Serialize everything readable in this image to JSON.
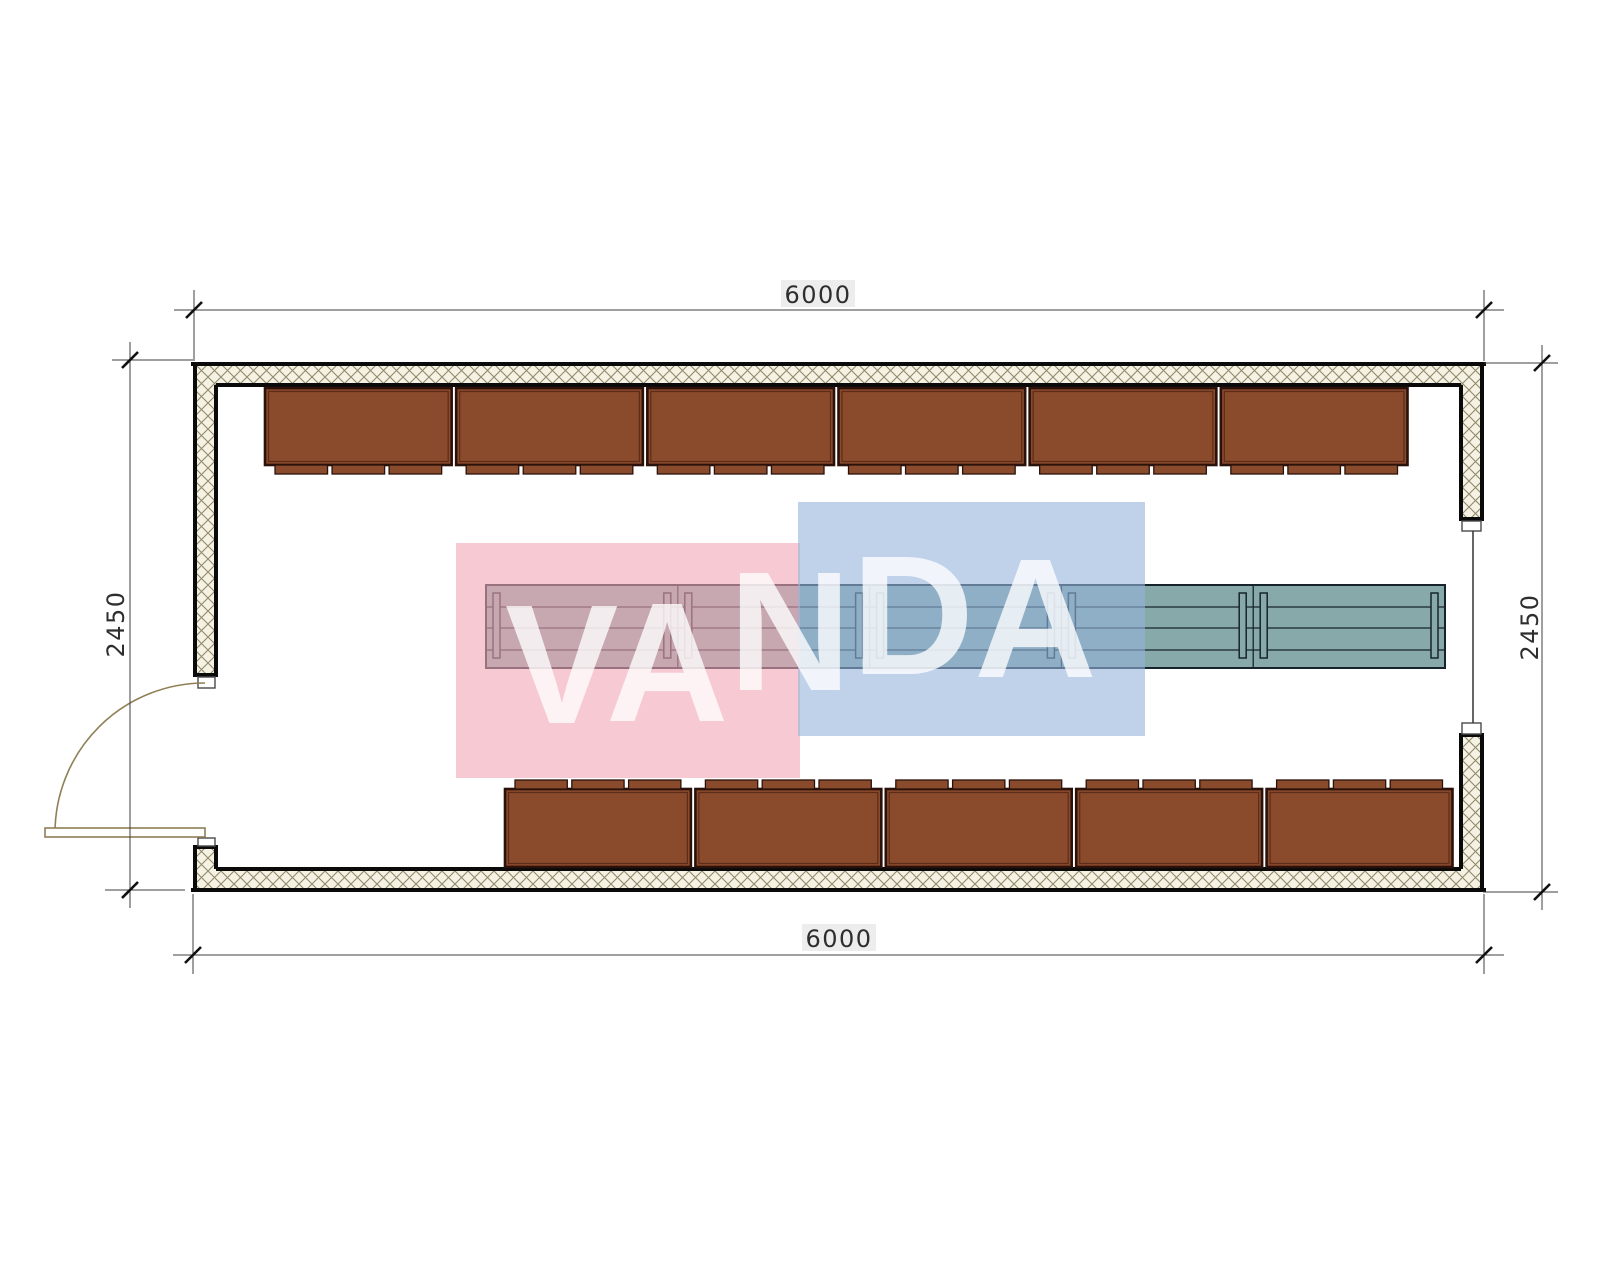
{
  "drawing": {
    "dim_top": "6000",
    "dim_bottom": "6000",
    "dim_left": "2450",
    "dim_right": "2450"
  },
  "watermark": {
    "text": "VANDA",
    "pink_color": "rgba(242,166,182,0.60)",
    "blue_color": "rgba(148,180,220,0.60)",
    "letter_color": "rgba(255,255,255,0.78)"
  },
  "furniture": {
    "top_row_units": 6,
    "bottom_row_units": 5,
    "tabs_per_unit": 3,
    "table_modules": 5,
    "table_legs_per_module": 2
  },
  "colors": {
    "cabinet_fill": "#8a4a2c",
    "cabinet_outline": "#2a120a",
    "cabinet_inner_line": "#5c2c18",
    "table_fill": "#87a9a9",
    "table_outline": "#17242e",
    "wall_outline": "#0a0a0a",
    "wall_hatch_bg": "#f5f1e3",
    "wall_hatch_line": "#8f8a6d",
    "door_line": "#8f7f55",
    "dimension_line": "#3f3f3f",
    "dimension_text": "#2e2e2e"
  }
}
